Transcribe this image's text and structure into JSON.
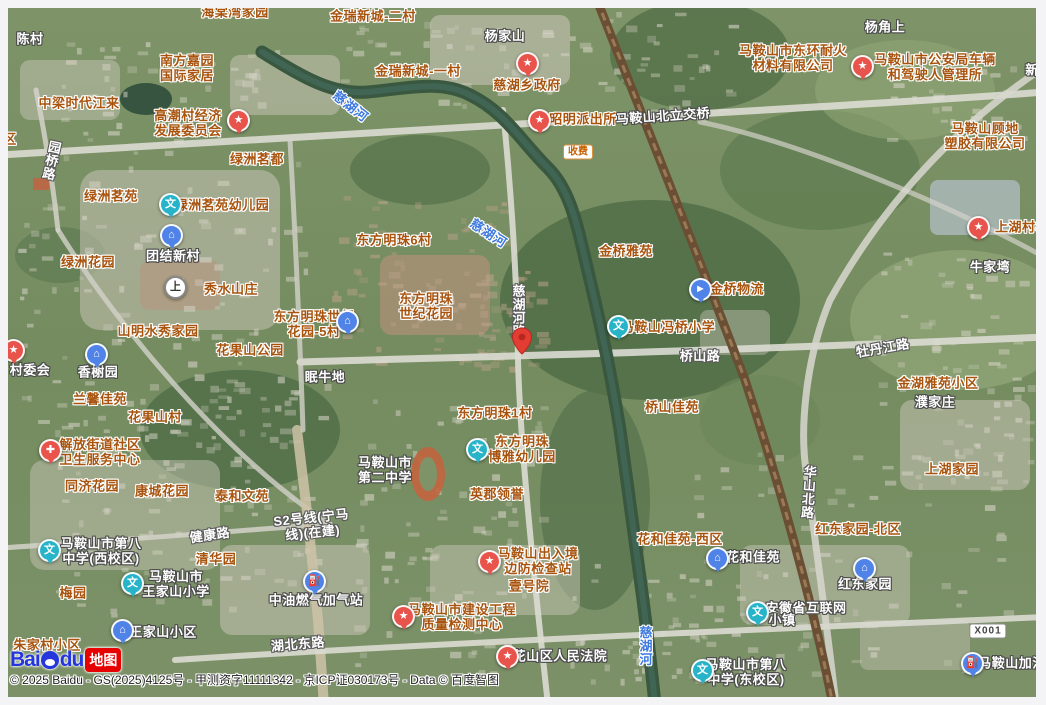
{
  "map": {
    "copyright": "© 2025 Baidu - GS(2025)4125号 - 甲测资字11111342 - 京ICP证030173号 - Data © 百度智图",
    "logo": {
      "bai": "Bai",
      "du": "du",
      "tag": "地图"
    },
    "colors": {
      "poi_red": "#e8544b",
      "poi_teal": "#27b4c8",
      "poi_blue": "#5083e8",
      "poi_white": "#ffffff",
      "label_area": "#a8540f",
      "label_place": "#ffffff",
      "label_river": "#3e79e0",
      "pin_red": "#e23c33"
    },
    "icon_glyphs": {
      "star": "★",
      "hospital": "✚",
      "school": "文",
      "estate": "⌂",
      "gas": "⛽",
      "logistics": "►",
      "metro": "上"
    },
    "pin": {
      "x": 522,
      "y": 341
    },
    "badges": [
      {
        "text": "收费",
        "x": 578,
        "y": 152,
        "style": "toll"
      },
      {
        "text": "X001",
        "x": 988,
        "y": 631,
        "style": "road-shield"
      }
    ],
    "labels": [
      {
        "text": "海棠湾家园",
        "x": 235,
        "y": 13,
        "cls": "area"
      },
      {
        "text": "金瑞新城-二村",
        "x": 373,
        "y": 17,
        "cls": "area"
      },
      {
        "lines": [
          "南方嘉园",
          "国际家居"
        ],
        "x": 187,
        "y": 69,
        "cls": "area"
      },
      {
        "text": "中梁时代江来",
        "x": 79,
        "y": 104,
        "cls": "area"
      },
      {
        "lines": [
          "高潮村经济",
          "发展委员会"
        ],
        "x": 188,
        "y": 124,
        "cls": "area"
      },
      {
        "text": "金瑞新城-一村",
        "x": 418,
        "y": 72,
        "cls": "area"
      },
      {
        "text": "慈湖乡政府",
        "x": 527,
        "y": 86,
        "cls": "area"
      },
      {
        "text": "昭明派出所",
        "x": 583,
        "y": 120,
        "cls": "area"
      },
      {
        "lines": [
          "马鞍山市东环耐火",
          "材料有限公司"
        ],
        "x": 793,
        "y": 59,
        "cls": "area"
      },
      {
        "lines": [
          "马鞍山市公安局车辆",
          "和驾驶人管理所"
        ],
        "x": 935,
        "y": 68,
        "cls": "area"
      },
      {
        "lines": [
          "马鞍山顾地",
          "塑胶有限公司"
        ],
        "x": 985,
        "y": 137,
        "cls": "area"
      },
      {
        "text": "绿洲茗都",
        "x": 257,
        "y": 160,
        "cls": "area"
      },
      {
        "text": "绿洲茗苑",
        "x": 111,
        "y": 197,
        "cls": "area"
      },
      {
        "text": "绿洲茗苑幼儿园",
        "x": 222,
        "y": 206,
        "cls": "area"
      },
      {
        "text": "上湖村村",
        "x": 1022,
        "y": 228,
        "cls": "area"
      },
      {
        "text": "东方明珠6村",
        "x": 394,
        "y": 241,
        "cls": "area"
      },
      {
        "text": "金桥雅苑",
        "x": 626,
        "y": 252,
        "cls": "area"
      },
      {
        "text": "绿洲花园",
        "x": 88,
        "y": 263,
        "cls": "area"
      },
      {
        "text": "秀水山庄",
        "x": 231,
        "y": 290,
        "cls": "area"
      },
      {
        "lines": [
          "东方明珠",
          "世纪花园"
        ],
        "x": 426,
        "y": 307,
        "cls": "area"
      },
      {
        "lines": [
          "东方明珠世纪",
          "花园-5村"
        ],
        "x": 314,
        "y": 325,
        "cls": "area"
      },
      {
        "text": "山明水秀家园",
        "x": 158,
        "y": 332,
        "cls": "area"
      },
      {
        "text": "花果山公园",
        "x": 250,
        "y": 351,
        "cls": "area"
      },
      {
        "text": "金桥物流",
        "x": 737,
        "y": 290,
        "cls": "area"
      },
      {
        "text": "马鞍山冯桥小学",
        "x": 668,
        "y": 328,
        "cls": "area"
      },
      {
        "text": "金湖雅苑小区",
        "x": 938,
        "y": 384,
        "cls": "area"
      },
      {
        "text": "桥山佳苑",
        "x": 672,
        "y": 408,
        "cls": "area"
      },
      {
        "text": "兰馨佳苑",
        "x": 100,
        "y": 400,
        "cls": "area"
      },
      {
        "text": "花果山村",
        "x": 155,
        "y": 418,
        "cls": "area"
      },
      {
        "text": "东方明珠1村",
        "x": 495,
        "y": 414,
        "cls": "area"
      },
      {
        "lines": [
          "解放街道社区",
          "卫生服务中心"
        ],
        "x": 100,
        "y": 453,
        "cls": "area"
      },
      {
        "lines": [
          "东方明珠",
          "博雅幼儿园"
        ],
        "x": 522,
        "y": 450,
        "cls": "area"
      },
      {
        "text": "同济花园",
        "x": 92,
        "y": 487,
        "cls": "area"
      },
      {
        "text": "康城花园",
        "x": 162,
        "y": 492,
        "cls": "area"
      },
      {
        "text": "泰和文苑",
        "x": 242,
        "y": 497,
        "cls": "area"
      },
      {
        "text": "英郡领誉",
        "x": 497,
        "y": 495,
        "cls": "area"
      },
      {
        "text": "上湖家园",
        "x": 952,
        "y": 470,
        "cls": "area"
      },
      {
        "text": "红东家园-北区",
        "x": 858,
        "y": 530,
        "cls": "area"
      },
      {
        "text": "花和佳苑-西区",
        "x": 680,
        "y": 540,
        "cls": "area"
      },
      {
        "text": "清华园",
        "x": 216,
        "y": 560,
        "cls": "area"
      },
      {
        "lines": [
          "马鞍山出入境",
          "边防检查站"
        ],
        "x": 538,
        "y": 562,
        "cls": "area"
      },
      {
        "text": "梅园",
        "x": 73,
        "y": 594,
        "cls": "area"
      },
      {
        "text": "壹号院",
        "x": 529,
        "y": 587,
        "cls": "area"
      },
      {
        "lines": [
          "马鞍山市建设工程",
          "质量检测中心"
        ],
        "x": 462,
        "y": 618,
        "cls": "area"
      },
      {
        "text": "朱家村小区",
        "x": 47,
        "y": 646,
        "cls": "area"
      },
      {
        "text": "区",
        "x": 10,
        "y": 140,
        "cls": "area"
      },
      {
        "text": "陈村",
        "x": 30,
        "y": 40,
        "cls": "place"
      },
      {
        "text": "杨家山",
        "x": 505,
        "y": 37,
        "cls": "place"
      },
      {
        "text": "杨角上",
        "x": 885,
        "y": 28,
        "cls": "place"
      },
      {
        "text": "新",
        "x": 1032,
        "y": 71,
        "cls": "place"
      },
      {
        "text": "马鞍山北立交桥",
        "x": 663,
        "y": 117,
        "cls": "place",
        "rot": -4
      },
      {
        "text": "牛家塆",
        "x": 990,
        "y": 268,
        "cls": "place"
      },
      {
        "text": "团结新村",
        "x": 173,
        "y": 257,
        "cls": "place"
      },
      {
        "text": "香榭园",
        "x": 98,
        "y": 373,
        "cls": "place"
      },
      {
        "text": "村委会",
        "x": 30,
        "y": 371,
        "cls": "place"
      },
      {
        "text": "眠牛地",
        "x": 325,
        "y": 378,
        "cls": "place"
      },
      {
        "text": "濮家庄",
        "x": 935,
        "y": 403,
        "cls": "place"
      },
      {
        "lines": [
          "马鞍山市",
          "第二中学"
        ],
        "x": 385,
        "y": 471,
        "cls": "place"
      },
      {
        "lines": [
          "马鞍山市第八",
          "中学(西校区)"
        ],
        "x": 101,
        "y": 552,
        "cls": "place"
      },
      {
        "lines": [
          "马鞍山市",
          "王家山小学"
        ],
        "x": 176,
        "y": 585,
        "cls": "place"
      },
      {
        "text": "王家山小区",
        "x": 163,
        "y": 633,
        "cls": "place"
      },
      {
        "text": "中油燃气加气站",
        "x": 316,
        "y": 601,
        "cls": "place"
      },
      {
        "text": "安徽省互联网",
        "x": 806,
        "y": 609,
        "cls": "place"
      },
      {
        "text": "小镇",
        "x": 782,
        "y": 621,
        "cls": "place"
      },
      {
        "text": "红东家园",
        "x": 865,
        "y": 585,
        "cls": "place"
      },
      {
        "text": "花和佳苑",
        "x": 753,
        "y": 558,
        "cls": "place"
      },
      {
        "text": "马鞍山加油",
        "x": 1012,
        "y": 664,
        "cls": "place"
      },
      {
        "text": "花山区人民法院",
        "x": 560,
        "y": 657,
        "cls": "place"
      },
      {
        "lines": [
          "马鞍山市第八",
          "中学(东校区)"
        ],
        "x": 746,
        "y": 673,
        "cls": "place"
      },
      {
        "text": "园桥路",
        "x": 50,
        "y": 160,
        "cls": "road",
        "vert": true,
        "rot": 12
      },
      {
        "text": "慈湖河路",
        "x": 517,
        "y": 311,
        "cls": "road",
        "vert": true
      },
      {
        "text": "桥山路",
        "x": 700,
        "y": 357,
        "cls": "road"
      },
      {
        "text": "牡丹江路",
        "x": 883,
        "y": 349,
        "cls": "road",
        "rot": -10
      },
      {
        "text": "华山北路",
        "x": 807,
        "y": 492,
        "cls": "road",
        "vert": true,
        "rot": 4
      },
      {
        "text": "健康路",
        "x": 210,
        "y": 536,
        "cls": "road",
        "rot": -8
      },
      {
        "lines": [
          "S2号线(宁马",
          "线)(在建)"
        ],
        "x": 312,
        "y": 526,
        "cls": "road",
        "rot": -6
      },
      {
        "text": "湖北东路",
        "x": 298,
        "y": 645,
        "cls": "road",
        "rot": -5
      },
      {
        "text": "慈湖河",
        "x": 350,
        "y": 107,
        "cls": "river",
        "rot": 38
      },
      {
        "text": "慈湖河",
        "x": 488,
        "y": 234,
        "cls": "river",
        "rot": 33
      },
      {
        "text": "慈湖河",
        "x": 644,
        "y": 646,
        "cls": "river",
        "vert": true
      }
    ],
    "pois": [
      {
        "type": "star",
        "color": "poi_red",
        "x": 238,
        "y": 121,
        "for": "高潮村经济发展委员会"
      },
      {
        "type": "star",
        "color": "poi_red",
        "x": 527,
        "y": 64,
        "for": "慈湖乡政府"
      },
      {
        "type": "star",
        "color": "poi_red",
        "x": 539,
        "y": 121,
        "for": "昭明派出所"
      },
      {
        "type": "star",
        "color": "poi_red",
        "x": 862,
        "y": 67,
        "for": "马鞍山市公安局车辆和驾驶人管理所"
      },
      {
        "type": "star",
        "color": "poi_red",
        "x": 978,
        "y": 228,
        "for": "上湖村村委会"
      },
      {
        "type": "star",
        "color": "poi_red",
        "x": 13,
        "y": 351,
        "for": "村委会"
      },
      {
        "type": "star",
        "color": "poi_red",
        "x": 489,
        "y": 562,
        "for": "马鞍山出入境边防检查站"
      },
      {
        "type": "star",
        "color": "poi_red",
        "x": 403,
        "y": 617,
        "for": "马鞍山市建设工程质量检测中心"
      },
      {
        "type": "star",
        "color": "poi_red",
        "x": 507,
        "y": 657,
        "for": "花山区人民法院"
      },
      {
        "type": "hospital",
        "color": "poi_red",
        "x": 50,
        "y": 451,
        "for": "解放街道社区卫生服务中心"
      },
      {
        "type": "school",
        "color": "poi_teal",
        "x": 170,
        "y": 205,
        "for": "绿洲茗苑幼儿园"
      },
      {
        "type": "school",
        "color": "poi_teal",
        "x": 618,
        "y": 327,
        "for": "马鞍山冯桥小学"
      },
      {
        "type": "school",
        "color": "poi_teal",
        "x": 477,
        "y": 450,
        "for": "东方明珠博雅幼儿园"
      },
      {
        "type": "school",
        "color": "poi_teal",
        "x": 49,
        "y": 551,
        "for": "马鞍山市第八中学(西校区)"
      },
      {
        "type": "school",
        "color": "poi_teal",
        "x": 132,
        "y": 584,
        "for": "马鞍山市王家山小学"
      },
      {
        "type": "school",
        "color": "poi_teal",
        "x": 757,
        "y": 613,
        "for": "安徽省互联网小镇"
      },
      {
        "type": "school",
        "color": "poi_teal",
        "x": 702,
        "y": 671,
        "for": "马鞍山市第八中学(东校区)"
      },
      {
        "type": "estate",
        "color": "poi_blue",
        "x": 171,
        "y": 236,
        "for": "团结新村"
      },
      {
        "type": "estate",
        "color": "poi_blue",
        "x": 96,
        "y": 355,
        "for": "香榭园"
      },
      {
        "type": "estate",
        "color": "poi_blue",
        "x": 347,
        "y": 322,
        "for": "东方明珠世纪花园-5村"
      },
      {
        "type": "estate",
        "color": "poi_blue",
        "x": 717,
        "y": 559,
        "for": "花和佳苑"
      },
      {
        "type": "estate",
        "color": "poi_blue",
        "x": 864,
        "y": 569,
        "for": "红东家园"
      },
      {
        "type": "estate",
        "color": "poi_blue",
        "x": 122,
        "y": 631,
        "for": "王家山小区"
      },
      {
        "type": "logistics",
        "color": "poi_blue",
        "x": 700,
        "y": 290,
        "for": "金桥物流"
      },
      {
        "type": "gas",
        "color": "poi_blue",
        "x": 314,
        "y": 582,
        "for": "中油燃气加气站"
      },
      {
        "type": "gas",
        "color": "poi_blue",
        "x": 972,
        "y": 664,
        "for": "马鞍山加油"
      },
      {
        "type": "metro",
        "color": "poi_white",
        "x": 175,
        "y": 288,
        "for": "上"
      }
    ]
  }
}
